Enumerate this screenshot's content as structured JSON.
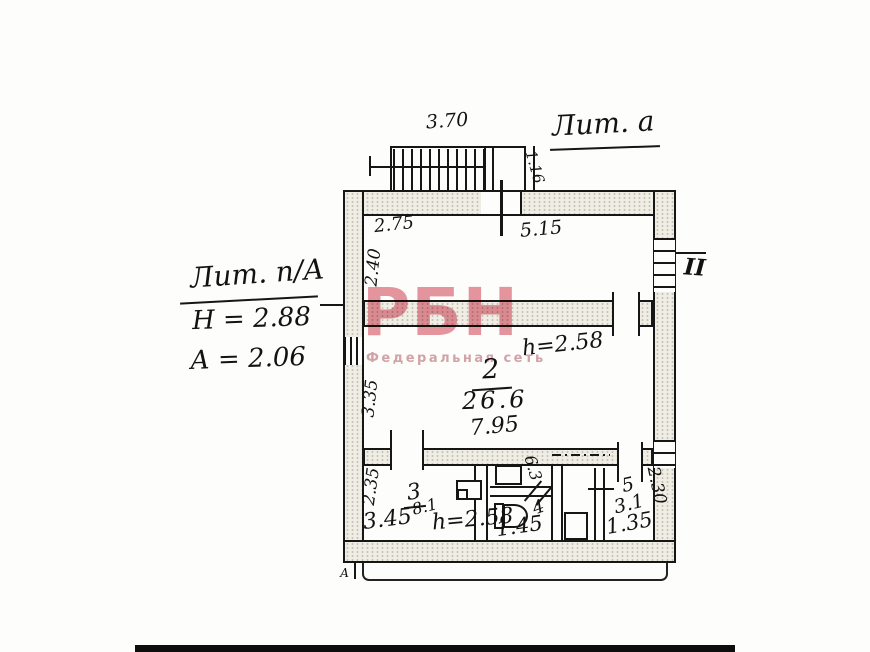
{
  "watermark": {
    "logo": "РБН",
    "subtitle": "Федеральная сеть"
  },
  "colors": {
    "watermark_pink": "#e2828f",
    "ink": "#161616"
  },
  "outside_labels": {
    "litera_top": "Лит. а",
    "litera_main": "Лит. п/А",
    "height_main": "Н = 2.88",
    "height_basement": "А = 2.06",
    "window_mark": "II",
    "axis_mark": "А"
  },
  "porch": {
    "width": "3.70",
    "door_width": "1.16"
  },
  "rooms": {
    "room1": {
      "dim_offset": "2.75",
      "dim_width": "5.15",
      "dim_depth": "2.40"
    },
    "room2": {
      "number": "2",
      "area": "26.6",
      "dim_width": "7.95",
      "dim_depth": "3.35",
      "height_mark": "h=2.58"
    },
    "room3": {
      "number": "3",
      "area": "8.1",
      "dim_width": "3.45",
      "dim_depth": "2.35",
      "height_mark": "h=2.58"
    },
    "bathroom": {
      "number": "4",
      "dim_width": "1.45",
      "dim_upper": "6.3"
    },
    "room5": {
      "number": "5",
      "area": "3.1",
      "dim_width": "1.35",
      "dim_depth": "2.30"
    }
  }
}
